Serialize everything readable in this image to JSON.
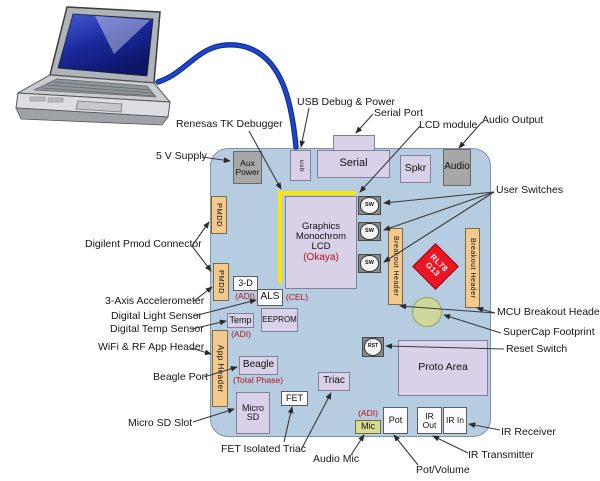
{
  "colors": {
    "board_fill": "#b6cce0",
    "board_border": "#7f93a8",
    "component_lavender": "#d8d1e8",
    "component_gray": "#a7a7a7",
    "header_tan": "#f3c98c",
    "mic_green": "#d9db93",
    "mcu_red": "#ee1421",
    "supercap_green": "#cdd69c",
    "debugger_yellow": "#ffe600",
    "annotation_red": "#b5121f",
    "cable_blue": "#1e44cc",
    "arrow_color": "#3a3a3a"
  },
  "cable": {
    "path": "M 158,82 C 190,72 200,38 242,46 C 283,55 292,105 296,147"
  },
  "debug_outline": {
    "path": "M 280,283 L 280,193 L 356,193"
  },
  "components": [
    {
      "name": "serial-port-tab",
      "text": "",
      "style": "lavender",
      "x": 333,
      "y": 135,
      "w": 42,
      "h": 16,
      "font": 8
    },
    {
      "name": "usb-connector",
      "text": "usb",
      "style": "lavender",
      "vertical": true,
      "x": 290,
      "y": 150,
      "w": 21,
      "h": 31,
      "font": 6.5
    },
    {
      "name": "serial-connector",
      "text": "Serial",
      "style": "lavender",
      "x": 317,
      "y": 150,
      "w": 73,
      "h": 28,
      "font": 11
    },
    {
      "name": "speaker",
      "text": "Spkr",
      "style": "lavender",
      "x": 400,
      "y": 155,
      "w": 31,
      "h": 28,
      "font": 10.5
    },
    {
      "name": "audio-jack",
      "text": "Audio",
      "style": "gray",
      "x": 443,
      "y": 149,
      "w": 28,
      "h": 37,
      "font": 10
    },
    {
      "name": "aux-power",
      "text": "Aux Power",
      "style": "gray",
      "x": 233,
      "y": 151,
      "w": 29,
      "h": 33,
      "font": 8.5
    },
    {
      "name": "pmod-connector-1",
      "text": "PMDD",
      "style": "tan",
      "vertical": true,
      "x": 211,
      "y": 196,
      "w": 16,
      "h": 38,
      "font": 7.5
    },
    {
      "name": "pmod-connector-2",
      "text": "PMDD",
      "style": "tan",
      "vertical": true,
      "x": 213,
      "y": 263,
      "w": 16,
      "h": 38,
      "font": 7.5
    },
    {
      "name": "app-header",
      "text": "App Header",
      "style": "tan",
      "vertical": true,
      "x": 212,
      "y": 330,
      "w": 16,
      "h": 77,
      "font": 8
    },
    {
      "name": "lcd",
      "style": "lcd lavender",
      "x": 285,
      "y": 196,
      "w": 72,
      "h": 93,
      "lines": [
        "Graphics",
        "Monochrom LCD"
      ],
      "sub": "(Okaya)",
      "font": 9.5
    },
    {
      "name": "accelerometer-3d",
      "text": "3-D",
      "style": "white",
      "x": 233,
      "y": 276,
      "w": 25,
      "h": 15,
      "font": 9
    },
    {
      "name": "als-sensor",
      "text": "ALS",
      "style": "white",
      "x": 257,
      "y": 289,
      "w": 26,
      "h": 17,
      "font": 10
    },
    {
      "name": "temp-sensor",
      "text": "Temp",
      "style": "lavender",
      "x": 227,
      "y": 313,
      "w": 27,
      "h": 15,
      "font": 9
    },
    {
      "name": "eeprom",
      "text": "EEPROM",
      "style": "lavender",
      "x": 261,
      "y": 308,
      "w": 37,
      "h": 24,
      "font": 8
    },
    {
      "name": "beagle-connector",
      "text": "Beagle",
      "style": "lavender",
      "x": 239,
      "y": 356,
      "w": 39,
      "h": 19,
      "font": 10
    },
    {
      "name": "micro-sd",
      "text": "Micro SD",
      "style": "lavender",
      "x": 236,
      "y": 392,
      "w": 34,
      "h": 42,
      "font": 9
    },
    {
      "name": "fet",
      "text": "FET",
      "style": "white",
      "x": 281,
      "y": 391,
      "w": 27,
      "h": 15,
      "font": 9
    },
    {
      "name": "triac",
      "text": "Triac",
      "style": "lavender",
      "x": 318,
      "y": 372,
      "w": 32,
      "h": 19,
      "font": 10
    },
    {
      "name": "mic",
      "text": "Mic",
      "style": "micgreen",
      "x": 355,
      "y": 420,
      "w": 26,
      "h": 14,
      "font": 9
    },
    {
      "name": "pot",
      "text": "Pot",
      "style": "white",
      "x": 383,
      "y": 407,
      "w": 25,
      "h": 27,
      "font": 9
    },
    {
      "name": "ir-out",
      "text": "IR Out",
      "style": "white",
      "x": 417,
      "y": 407,
      "w": 25,
      "h": 27,
      "font": 8.5
    },
    {
      "name": "ir-in",
      "text": "IR In",
      "style": "white",
      "x": 443,
      "y": 407,
      "w": 24,
      "h": 27,
      "font": 8.5
    },
    {
      "name": "reset-button",
      "text": "RST",
      "style": "button",
      "x": 362,
      "y": 337,
      "w": 22,
      "h": 20,
      "font": 5
    },
    {
      "name": "user-switch-1",
      "text": "SW",
      "style": "button",
      "x": 358,
      "y": 196,
      "w": 23,
      "h": 19,
      "font": 5.5
    },
    {
      "name": "user-switch-2",
      "text": "SW",
      "style": "button",
      "x": 358,
      "y": 222,
      "w": 23,
      "h": 19,
      "font": 5.5
    },
    {
      "name": "user-switch-3",
      "text": "SW",
      "style": "button",
      "x": 358,
      "y": 254,
      "w": 23,
      "h": 19,
      "font": 5.5
    },
    {
      "name": "breakout-header-1",
      "text": "Breakout Header",
      "style": "tan",
      "vertical": true,
      "x": 388,
      "y": 228,
      "w": 15,
      "h": 77,
      "font": 7
    },
    {
      "name": "breakout-header-2",
      "text": "Breakout Header",
      "style": "tan",
      "vertical": true,
      "x": 465,
      "y": 228,
      "w": 15,
      "h": 80,
      "font": 7
    },
    {
      "name": "proto-area",
      "text": "Proto Area",
      "style": "lavender",
      "x": 398,
      "y": 340,
      "w": 90,
      "h": 56,
      "font": 10.5
    },
    {
      "name": "supercap",
      "style": "circle",
      "x": 412,
      "y": 297,
      "w": 30,
      "h": 30
    },
    {
      "name": "mcu-rl78-g13",
      "style": "diamond",
      "lines": [
        "RL78",
        "G13"
      ],
      "cx": 435,
      "cy": 266,
      "size": 33,
      "font": 8
    }
  ],
  "annotations": [
    {
      "name": "note-adi-3d",
      "text": "(ADI)",
      "x": 245,
      "y": 291
    },
    {
      "name": "note-cel-als",
      "text": "(CEL)",
      "x": 297,
      "y": 292
    },
    {
      "name": "note-adi-temp",
      "text": "(ADI)",
      "x": 241,
      "y": 329
    },
    {
      "name": "note-total-phase",
      "text": "(Total Phase)",
      "x": 258,
      "y": 375
    },
    {
      "name": "note-adi-mic",
      "text": "(ADI)",
      "x": 368,
      "y": 408
    }
  ],
  "callouts": [
    {
      "name": "label-usb-debug-power",
      "text": "USB Debug & Power",
      "x": 297,
      "y": 96,
      "arrows": [
        [
          309,
          108,
          301,
          147
        ]
      ]
    },
    {
      "name": "label-serial-port",
      "text": "Serial Port",
      "x": 374,
      "y": 107,
      "arrows": [
        [
          373,
          114,
          356,
          133
        ]
      ]
    },
    {
      "name": "label-lcd-module",
      "text": "LCD module",
      "x": 419,
      "y": 119,
      "arrows": [
        [
          420,
          126,
          360,
          192
        ]
      ]
    },
    {
      "name": "label-audio-output",
      "text": "Audio Output",
      "x": 482,
      "y": 114,
      "arrows": [
        [
          482,
          122,
          459,
          148
        ]
      ]
    },
    {
      "name": "label-renesas-tk-debugger",
      "text": "Renesas TK Debugger",
      "x": 176,
      "y": 118,
      "arrows": [
        [
          249,
          131,
          281,
          189
        ]
      ]
    },
    {
      "name": "label-5v-supply",
      "text": "5 V Supply",
      "x": 156,
      "y": 150,
      "arrows": [
        [
          202,
          157,
          230,
          161
        ]
      ]
    },
    {
      "name": "label-digilent-pmod",
      "text": "Digilent Pmod Connector",
      "x": 85,
      "y": 238,
      "arrows": [
        [
          192,
          246,
          209,
          222
        ],
        [
          192,
          246,
          211,
          271
        ]
      ]
    },
    {
      "name": "label-3axis-accelerometer",
      "text": "3-Axis Accelerometer",
      "x": 105,
      "y": 295,
      "arrows": [
        [
          194,
          301,
          212,
          287
        ]
      ]
    },
    {
      "name": "label-digital-light-sensor",
      "text": "Digital Light Sensor",
      "x": 111,
      "y": 310,
      "arrows": [
        [
          194,
          316,
          256,
          300
        ]
      ]
    },
    {
      "name": "label-digital-temp-sensor",
      "text": "Digital Temp Sensor",
      "x": 110,
      "y": 323,
      "arrows": [
        [
          192,
          329,
          226,
          321
        ]
      ]
    },
    {
      "name": "label-wifi-rf-app-header",
      "text": "WiFi & RF App Header",
      "x": 98,
      "y": 341,
      "arrows": [
        [
          191,
          348,
          211,
          354
        ]
      ]
    },
    {
      "name": "label-beagle-port",
      "text": "Beagle Port",
      "x": 153,
      "y": 371,
      "arrows": [
        [
          204,
          377,
          237,
          367
        ]
      ]
    },
    {
      "name": "label-micro-sd-slot",
      "text": "Micro SD Slot",
      "x": 128,
      "y": 417,
      "arrows": [
        [
          193,
          422,
          234,
          409
        ]
      ]
    },
    {
      "name": "label-fet-isolated-triac",
      "text": "FET Isolated Triac",
      "x": 221,
      "y": 443,
      "arrows": [
        [
          284,
          442,
          292,
          407
        ],
        [
          301,
          450,
          331,
          393
        ]
      ]
    },
    {
      "name": "label-audio-mic",
      "text": "Audio Mic",
      "x": 313,
      "y": 453,
      "arrows": [
        [
          351,
          455,
          364,
          435
        ]
      ]
    },
    {
      "name": "label-pot-volume",
      "text": "Pot/Volume",
      "x": 416,
      "y": 464,
      "arrows": [
        [
          418,
          465,
          394,
          435
        ]
      ]
    },
    {
      "name": "label-ir-transmitter",
      "text": "IR Transmitter",
      "x": 468,
      "y": 449,
      "arrows": [
        [
          468,
          453,
          433,
          436
        ]
      ]
    },
    {
      "name": "label-ir-receiver",
      "text": "IR Receiver",
      "x": 501,
      "y": 426,
      "arrows": [
        [
          500,
          430,
          469,
          424
        ]
      ]
    },
    {
      "name": "label-user-switches",
      "text": "User Switches",
      "x": 496,
      "y": 184,
      "arrows": [
        [
          494,
          192,
          384,
          203
        ],
        [
          494,
          192,
          384,
          230
        ],
        [
          494,
          192,
          384,
          262
        ]
      ]
    },
    {
      "name": "label-mcu-breakout-headers",
      "text": "MCU Breakout Headers",
      "x": 497,
      "y": 306,
      "arrows": [
        [
          495,
          313,
          400,
          306
        ],
        [
          495,
          313,
          477,
          308
        ]
      ]
    },
    {
      "name": "label-supercap-footprint",
      "text": "SuperCap Footprint",
      "x": 503,
      "y": 326,
      "arrows": [
        [
          501,
          333,
          444,
          315
        ]
      ]
    },
    {
      "name": "label-reset-switch",
      "text": "Reset Switch",
      "x": 506,
      "y": 343,
      "arrows": [
        [
          504,
          349,
          386,
          346
        ]
      ]
    }
  ]
}
